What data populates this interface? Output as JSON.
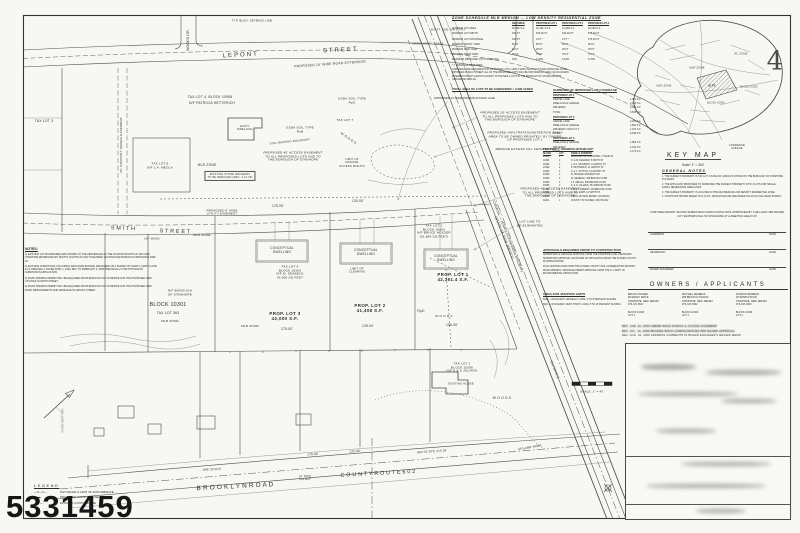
{
  "sheet": {
    "number": "4",
    "scan_number": "5331459"
  },
  "key_map": {
    "title": "KEY MAP",
    "scale": "Scale: 1\" = 300'"
  },
  "zone_schedule": {
    "title": "ZONE SCHEDULE   MLR MEDIUM — LOW DENSITY RESIDENTIAL ZONE",
    "columns": [
      "REQUIRED",
      "PROPOSED LOT 1",
      "PROPOSED LOT 2",
      "PROPOSED LOT 3"
    ],
    "rows": [
      {
        "label": "MINIMUM LOT AREA",
        "r": "40,000 S.F.",
        "p1": "42,361.4 S.F.",
        "p2": "41,408 S.F.",
        "p3": "42,000 S.F."
      },
      {
        "label": "MINIMUM LOT WIDTH",
        "r": "150 FT",
        "p1": "150.00 FT",
        "p2": "150.00 FT",
        "p3": "175.00 FT"
      },
      {
        "label": "MINIMUM LOT FRONTAGE",
        "r": "150 FT",
        "p1": "0 FT *",
        "p2": "0 FT *",
        "p3": "175.00 FT"
      },
      {
        "label": "MINIMUM FRONT YARD",
        "r": "50 FT",
        "p1": "50 FT",
        "p2": "50 FT",
        "p3": "50 FT"
      },
      {
        "label": "MINIMUM SIDE YARD",
        "r": "25 FT",
        "p1": "25 FT",
        "p2": "25 FT",
        "p3": "25 FT"
      },
      {
        "label": "MINIMUM REAR YARD",
        "r": "75 FT",
        "p1": "75 FT",
        "p2": "75 FT",
        "p3": "75 FT"
      },
      {
        "label": "MAXIMUM IMPROVED LOT COVERAGE",
        "r": "15%",
        "p1": "3.46%",
        "p2": "4.18%",
        "p3": "5.76%"
      }
    ],
    "footnote": "* = VARIANCE REQUIRED",
    "note": "VARIANCES ARE REQUIRED FOR PROPOSED LOTS 1 AND 2 WHICH WILL NOT HAVE FRONTAGE ON AN IMPROVED PUBLIC STREET. ALL OF THE PROPOSED LOTS WILL BE PROVIDED ACCESS VIA AN ACCESS EASEMENT WHICH GRANTS ACCESS TO HOUSES & LOTS IN THE BOROUGH OF STANHOPE (PER ORDINANCE 2003-14)."
  },
  "subdivision_notes": {
    "total_area": "TOTAL AREA OF LOTS TO BE SUBDIVIDED = 2.998 ACRES",
    "lane_note": "PROPOSED 24' WIDE PRIVATE ACCESS LANE"
  },
  "coverage": {
    "title": "SUMMARY OF IMPROVED LOT COVERAGE",
    "rows": [
      {
        "a": "PROPOSED LOT 1",
        "b": "",
        "c": "hdr"
      },
      {
        "a": "GRAVEL LANE",
        "b": "1,381 S.F."
      },
      {
        "a": "DWELLING & GARAGE",
        "b": "2,254 S.F."
      },
      {
        "a": "DRIVEWAY",
        "b": "2,000 S.F."
      },
      {
        "a": "TOTAL",
        "b": "5,635 S.F."
      },
      {
        "a": "PROPOSED LOT 2",
        "b": "",
        "c": "hdr"
      },
      {
        "a": "GRAVEL LANE",
        "b": "3,024 S.F."
      },
      {
        "a": "DWELLING & GARAGE",
        "b": "1,863 S.F."
      },
      {
        "a": "DRIVEWAY FOR LOT 3",
        "b": "1,152 S.F."
      },
      {
        "a": "TOTAL",
        "b": "6,039 S.F."
      },
      {
        "a": "PROPOSED LOT 3",
        "b": "",
        "c": "hdr"
      },
      {
        "a": "DWELLING & GARAGE",
        "b": "1,863 S.F."
      },
      {
        "a": "DRIVEWAY",
        "b": "2,310 S.F."
      },
      {
        "a": "TOTAL",
        "b": "4,173 S.F."
      }
    ]
  },
  "property_owners": {
    "title": "PROPERTY OWNERS WITHIN 200'",
    "columns": [
      "BLOCK",
      "LOT",
      "NAME & ADDRESS"
    ],
    "rows": [
      {
        "blk": "10301",
        "lot": "1",
        "name": "BOROUGH OF STANHOPE, 77 MAIN ST"
      },
      {
        "blk": "10301",
        "lot": "2",
        "name": "R. & M. DEGRAW, 5 SMITH ST"
      },
      {
        "blk": "10302",
        "lot": "1",
        "name": "J. & C. MCGRATH, 9 LEPONT ST"
      },
      {
        "blk": "10302",
        "lot": "2",
        "name": "P. HETTERICH, 11 LEPONT ST"
      },
      {
        "blk": "10302",
        "lot": "3",
        "name": "S. & L. SUTTON, 13 LEPONT ST"
      },
      {
        "blk": "10303",
        "lot": "1",
        "name": "B. HOLDER, MCKENZY DR"
      },
      {
        "blk": "10303",
        "lot": "2",
        "name": "M. SEABECK, 259 BROOKLYN RD"
      },
      {
        "blk": "10303",
        "lot": "4",
        "name": "J.A. MEOLA, 255 BROOKLYN RD"
      },
      {
        "blk": "10306",
        "lot": "1",
        "name": "K. & S. JULIANO, 251 BROOKLYN RD"
      },
      {
        "blk": "10306",
        "lot": "2",
        "name": "T. & D. FORREST, 249 BROOKLYN RD"
      },
      {
        "blk": "10901",
        "lot": "1",
        "name": "G. & A. RAPP, 12 SMITH ST"
      },
      {
        "blk": "10901",
        "lot": "5",
        "name": "STATE OF NEW JERSEY (CONRAIL)"
      },
      {
        "blk": "11001",
        "lot": "1",
        "name": "COUNTY OF SUSSEX, ROUTE 602"
      }
    ]
  },
  "approvals_required": {
    "title": "APPROVALS REQUIRED PRIOR TO CONSTRUCTION",
    "items": [
      "SUBDIVISION & VARIANCE APPROVAL FROM THE STANHOPE LAND USE BOARD",
      "SUBDIVISION APPROVAL OR WAIVER OF APPLICATION FROM THE SUSSEX COUNTY PLANNING BOARD",
      "PLAN CERTIFICATION FROM THE SUSSEX COUNTY SOIL CONSERVATION DISTRICT",
      "ROAD OPENING / DRAINAGE PERMIT APPROVAL FROM THE N.J. DEPT. OF ENVIRONMENTAL PROTECTION"
    ]
  },
  "usda_soils": {
    "title": "USDA SOIL MAPPING UNITS",
    "items": [
      "RoB — ROCKAWAY GRAVELLY LOAM, 3 TO 8 PERCENT SLOPES",
      "RpD — ROCKAWAY VERY STONY LOAM, 8 TO 15 PERCENT SLOPES"
    ]
  },
  "general_notes": {
    "title": "GENERAL NOTES",
    "items": [
      "1. THE SUBJECT PROPERTY IS TAX LOT 1 IN BLOCK 10303 AS SHOWN ON THE BOROUGH OF STANHOPE TAX MAPS.",
      "2. THE APPLICANT PROPOSES TO SUBDIVIDE THE SUBJECT PROPERTY INTO 3 LOTS FOR SINGLE FAMILY RESIDENTIAL DWELLINGS.",
      "3. THE SUBJECT PROPERTY IS LOCATED IN THE MLR MEDIUM-LOW DENSITY RESIDENTIAL ZONE.",
      "4. CONTOURS SHOWN REFER TO N.G.V.D. 1929 DATUM AND ARE BASED ON AN ACTUAL FIELD SURVEY."
    ]
  },
  "approval_block": {
    "paragraph": "THIS PRELIMINARY MAJOR SUBDIVISION APPLICATION WAS APPROVED BY THE LAND USE BOARD OF THE BOROUGH OF STANHOPE AT A MEETING HELD ON",
    "rows": [
      {
        "label": "CHAIRMAN",
        "right": "DATE"
      },
      {
        "label": "SECRETARY",
        "right": "DATE"
      },
      {
        "label": "BOARD ENGINEER",
        "right": "DATE"
      }
    ]
  },
  "owners_applicants": {
    "title": "OWNERS / APPLICANTS",
    "columns": [
      "BRUCE HOLDER\nMCKENZY DRIVE\nSTANHOPE, NEW JERSEY\n973-347-9517\n\nBLOCK 10303\nLOT 1",
      "MICHAEL SEABECK\n259 BROOKLYN ROAD\nSTANHOPE, NEW JERSEY\n973-347-0522\n\nBLOCK 10303\nLOT 1",
      "SHARON SEABECK\n26 SPARTA ROAD\nSTANHOPE, NEW JERSEY\n973-347-4643\n\nBLOCK 10306\nLOT 4"
    ]
  },
  "revisions": {
    "items": [
      "REV.  JAN. 22, 2009  AMEND ROAD RADIUS & ACCESS EASEMENT",
      "REV.  JUL. 10, 2008  REVISED ROAD CONFIGURATION PER BOARD APPROVAL",
      "REV.  AUG. 26, 2008  ADDRESS COMMENTS IN BOARD ENGINEER'S REVIEW MEMO"
    ]
  },
  "notes": {
    "title": "NOTES:",
    "items": [
      "1) EXISTING LOT BOUNDARIES ARE SHOWN TO THE CENTERLINE OF THE VACATED RIGHTS OF WAY PER STANHOPE REVERSIONARY RIGHTS. RIGHTS OF WAY HAVE BEEN VACATED PER BOROUGH ORDINANCE #499-02.",
      "2) EXISTING CONDITIONS, INCLUDING WETLANDS BUFFER, ARE BASED ON A SURVEY BY MARK J. MANTYLA PE & LS ORIGINALLY DATED APRIL 1, 1994, REV. TO FEBRUARY 6, 2008 SPECIFICALLY FOR THIS MAJOR SUBDIVISION APPLICATION.",
      "3) ROAD OPENING PERMIT WILL BE REQUIRED FROM BOROUGH OF STANHOPE FOR THE PROPOSED NEW UTILITIES IN SMITH STREET.",
      "4) ROAD OPENING PERMIT WILL BE REQUIRED FROM BOROUGH OF STANHOPE FOR THE PROPOSED NEW ROAD IMPROVEMENTS AND DRAINAGE IN LEPONT STREET."
    ]
  },
  "legend": {
    "title": "LEGEND",
    "items": [
      {
        "sym": "—×—×—",
        "label": "SILT FENCE & LIMIT OF DISTURBANCE"
      },
      {
        "sym": "▬▬",
        "label": "PROPOSED CONTOUR LINE"
      },
      {
        "sym": "— ·· —",
        "label": "EXISTING CONTOUR LINE"
      }
    ]
  },
  "plan": {
    "labels": [
      {
        "t": "L E P O N T",
        "x": 240,
        "y": 56,
        "r": -3,
        "s": 6
      },
      {
        "t": "S T R E E T",
        "x": 340,
        "y": 51,
        "r": -3,
        "s": 6
      },
      {
        "t": "PROPOSED 24' WIDE ROAD EXTENSION",
        "x": 330,
        "y": 64,
        "r": -4,
        "s": 3.4,
        "c": "it"
      },
      {
        "t": "WOODS DR.",
        "x": 188,
        "y": 40,
        "r": -90,
        "s": 3.4
      },
      {
        "t": "TYP. BLDG. SETBACK LINE",
        "x": 252,
        "y": 21,
        "s": 2.8
      },
      {
        "t": "EXIST. SAN. MH (TYP.)",
        "x": 448,
        "y": 30,
        "s": 2.8
      },
      {
        "t": "MATCH EXIST. GRADE",
        "x": 428,
        "y": 44,
        "s": 2.6
      },
      {
        "t": "TAX LOT 4, BLOCK 10908",
        "x": 210,
        "y": 97,
        "s": 3.4
      },
      {
        "t": "N/F PATRICIA HETTERICH",
        "x": 212,
        "y": 103,
        "s": 3.4
      },
      {
        "t": "20' SANITARY SEWER EASEMENT",
        "x": 122,
        "y": 145,
        "r": -90,
        "s": 3.1
      },
      {
        "t": "TAX LOT 3",
        "x": 44,
        "y": 121,
        "s": 3.4
      },
      {
        "t": "TAX LOT 8\nN/F J.A. MEOLA",
        "x": 160,
        "y": 166,
        "s": 3.1
      },
      {
        "t": "EXIST.\nDWELLING",
        "x": 245,
        "y": 128,
        "s": 2.7
      },
      {
        "t": "USDA SOIL TYPE\nRpD",
        "x": 352,
        "y": 101,
        "s": 3.1
      },
      {
        "t": "USDA SOIL TYPE\nRoB",
        "x": 300,
        "y": 130,
        "s": 3.1
      },
      {
        "t": "SOIL MAPPING BOUNDARY",
        "x": 290,
        "y": 142,
        "r": -6,
        "s": 2.8
      },
      {
        "t": "TAX LOT 7",
        "x": 345,
        "y": 121,
        "s": 3.1
      },
      {
        "t": "PROPOSED 40' ACCESS EASEMENT\nTO ALL PROPOSED LOTS AND TO\nTHE BOROUGH OF STANHOPE",
        "x": 293,
        "y": 157,
        "s": 3.1,
        "c": "it"
      },
      {
        "t": "MLR ZONE",
        "x": 207,
        "y": 166,
        "s": 3.3
      },
      {
        "t": "EXISTING STONE DRIVEWAY\nTO BE REMOVED (REV. 4-21-09)",
        "x": 230,
        "y": 176,
        "s": 2.6,
        "c": "box"
      },
      {
        "t": "PROPOSED 8' WIDE\nUTILITY EASEMENT",
        "x": 222,
        "y": 213,
        "s": 2.9,
        "c": "it"
      },
      {
        "t": "175.00'",
        "x": 278,
        "y": 207,
        "s": 3.3
      },
      {
        "t": "125.00'",
        "x": 358,
        "y": 202,
        "s": 3.3
      },
      {
        "t": "LIMIT OF\nPRIVATE\nACCESS RIGHTS",
        "x": 352,
        "y": 163,
        "s": 2.8
      },
      {
        "t": "W O O D S",
        "x": 348,
        "y": 139,
        "r": 35,
        "s": 3.3
      },
      {
        "t": "CONRAIL — (ERIE LACKAWANNA RAILWAY)\n(STATE OF NEW JERSEY)",
        "x": 506,
        "y": 237,
        "r": 68,
        "s": 3.4
      },
      {
        "t": "S51°29'50\"E",
        "x": 554,
        "y": 370,
        "r": 68,
        "s": 3.1
      },
      {
        "t": "PROPOSED 20' ACCESS EASEMENT\nTO ALL PROPOSED LOTS AND TO\nTHE BOROUGH OF STANHOPE",
        "x": 510,
        "y": 117,
        "s": 3.1,
        "c": "it"
      },
      {
        "t": "PROPOSED INFILTRATION/DETENTION BASIN\nAREA TO BE OWNED PRIVATELY BY OWNER\nOF PROPOSED LOT 1",
        "x": 525,
        "y": 137,
        "s": 3.1,
        "c": "it"
      },
      {
        "t": "REMOVE EXCESS FILL FROM LOT 1",
        "x": 525,
        "y": 150,
        "s": 3.1,
        "c": "it"
      },
      {
        "t": "PROPOSED 40' ACCESS EASEMENT\nTO ALL PROPOSED LOTS AND TO\nTHE BOROUGH OF STANHOPE",
        "x": 550,
        "y": 193,
        "s": 3.1,
        "c": "it"
      },
      {
        "t": "LOT LINE TO\nBE ELIMINATED",
        "x": 530,
        "y": 224,
        "s": 3.1
      },
      {
        "t": "TAX LOT 1\nBLOCK 10303\nN/F BRUCE HOLDER\n(51,864 SQ FEET)",
        "x": 434,
        "y": 232,
        "s": 3.1
      },
      {
        "t": "CONCEPTUAL\nDWELLING",
        "x": 282,
        "y": 251,
        "s": 3.2
      },
      {
        "t": "CONCEPTUAL\nDWELLING",
        "x": 366,
        "y": 253,
        "s": 3.2
      },
      {
        "t": "CONCEPTUAL\nDWELLING",
        "x": 446,
        "y": 259,
        "s": 3.2
      },
      {
        "t": "TAX LOT 4\nBLOCK 10303\nN/F M. SEABECK\n42,000 SQ FEET",
        "x": 290,
        "y": 273,
        "s": 3.1
      },
      {
        "t": "LIMIT OF\nCLEARING",
        "x": 357,
        "y": 271,
        "s": 2.9
      },
      {
        "t": "PROP. LOT 3\n42,000 S.F.",
        "x": 285,
        "y": 316,
        "s": 4.4,
        "c": "bd"
      },
      {
        "t": "175.00'",
        "x": 287,
        "y": 330,
        "s": 3.3
      },
      {
        "t": "MLR ZONE",
        "x": 250,
        "y": 327,
        "s": 3.1
      },
      {
        "t": "PROP. LOT 2\n41,408 S.F.",
        "x": 370,
        "y": 308,
        "s": 4.4,
        "c": "bd"
      },
      {
        "t": "139.00'",
        "x": 368,
        "y": 327,
        "s": 3.3
      },
      {
        "t": "PROP. LOT 1\n42,361.4 S.F.",
        "x": 453,
        "y": 277,
        "s": 4.4,
        "c": "bd"
      },
      {
        "t": "196.30'",
        "x": 452,
        "y": 326,
        "s": 3.3
      },
      {
        "t": "RpD",
        "x": 421,
        "y": 311,
        "s": 3.4
      },
      {
        "t": "W O O D S",
        "x": 444,
        "y": 317,
        "s": 3.1
      },
      {
        "t": "S M I T H",
        "x": 123,
        "y": 229,
        "r": 2,
        "s": 5.4
      },
      {
        "t": "S T R E E T",
        "x": 175,
        "y": 232,
        "r": 2,
        "s": 5.4
      },
      {
        "t": "(40' WIDE)",
        "x": 152,
        "y": 239,
        "s": 2.8
      },
      {
        "t": "MLR ZONE",
        "x": 202,
        "y": 236,
        "s": 3.1
      },
      {
        "t": "N/F BOROUGH\nOF STANHOPE",
        "x": 180,
        "y": 293,
        "s": 3.1
      },
      {
        "t": "BLOCK 10301",
        "x": 168,
        "y": 305,
        "s": 5.4
      },
      {
        "t": "TAX LOT 363",
        "x": 168,
        "y": 313,
        "s": 3.4
      },
      {
        "t": "MLR ZONE",
        "x": 170,
        "y": 322,
        "s": 3.1
      },
      {
        "t": "TAX LOT 1\nBLOCK 10306\nN/F K & S JULIANO",
        "x": 462,
        "y": 368,
        "s": 3.1
      },
      {
        "t": "EXISTING HOUSE",
        "x": 461,
        "y": 384,
        "s": 2.7
      },
      {
        "t": "W O O D S",
        "x": 502,
        "y": 398,
        "s": 3.4
      },
      {
        "t": "UPLAND AREA",
        "x": 530,
        "y": 448,
        "r": -10,
        "s": 3.1
      },
      {
        "t": "B R O O K L Y N   R O A D",
        "x": 235,
        "y": 487,
        "r": -3,
        "s": 6.4
      },
      {
        "t": "C O U N T Y   R O U T E   6 0 2",
        "x": 378,
        "y": 474,
        "r": -3,
        "s": 5.4
      },
      {
        "t": "40' ROW\nTAX MAP",
        "x": 305,
        "y": 478,
        "r": -3,
        "s": 2.6
      },
      {
        "t": "N86°29'39\"E",
        "x": 212,
        "y": 470,
        "r": -3,
        "s": 2.9
      },
      {
        "t": "175.00'",
        "x": 313,
        "y": 455,
        "r": -3,
        "s": 3.1
      },
      {
        "t": "125.00'",
        "x": 355,
        "y": 452,
        "r": -3,
        "s": 3.1
      },
      {
        "t": "N84°51'29\"E   215.28'",
        "x": 432,
        "y": 452,
        "r": -4,
        "s": 2.9
      },
      {
        "t": "SCALE: 1\" = 40'",
        "x": 592,
        "y": 392,
        "s": 2.9
      },
      {
        "t": "FILED MAP REF.",
        "x": 63,
        "y": 420,
        "r": -90,
        "s": 2.9,
        "c": "bl"
      },
      {
        "t": "MLR ZONE",
        "x": 697,
        "y": 68,
        "s": 2.6
      },
      {
        "t": "RC ZONE",
        "x": 741,
        "y": 54,
        "s": 2.6
      },
      {
        "t": "MLR ZONE",
        "x": 664,
        "y": 86,
        "s": 2.6
      },
      {
        "t": "SITE",
        "x": 712,
        "y": 86,
        "s": 2.8,
        "c": "bd"
      },
      {
        "t": "BLOCK 10303",
        "x": 749,
        "y": 88,
        "s": 2.4
      },
      {
        "t": "BLOCK 10901",
        "x": 716,
        "y": 104,
        "s": 2.4
      },
      {
        "t": "LAWRENCE\nAVENUE",
        "x": 737,
        "y": 147,
        "s": 2.6
      },
      {
        "t": "4",
        "x": 775,
        "y": 62,
        "s": 26,
        "c": "lt"
      }
    ]
  }
}
